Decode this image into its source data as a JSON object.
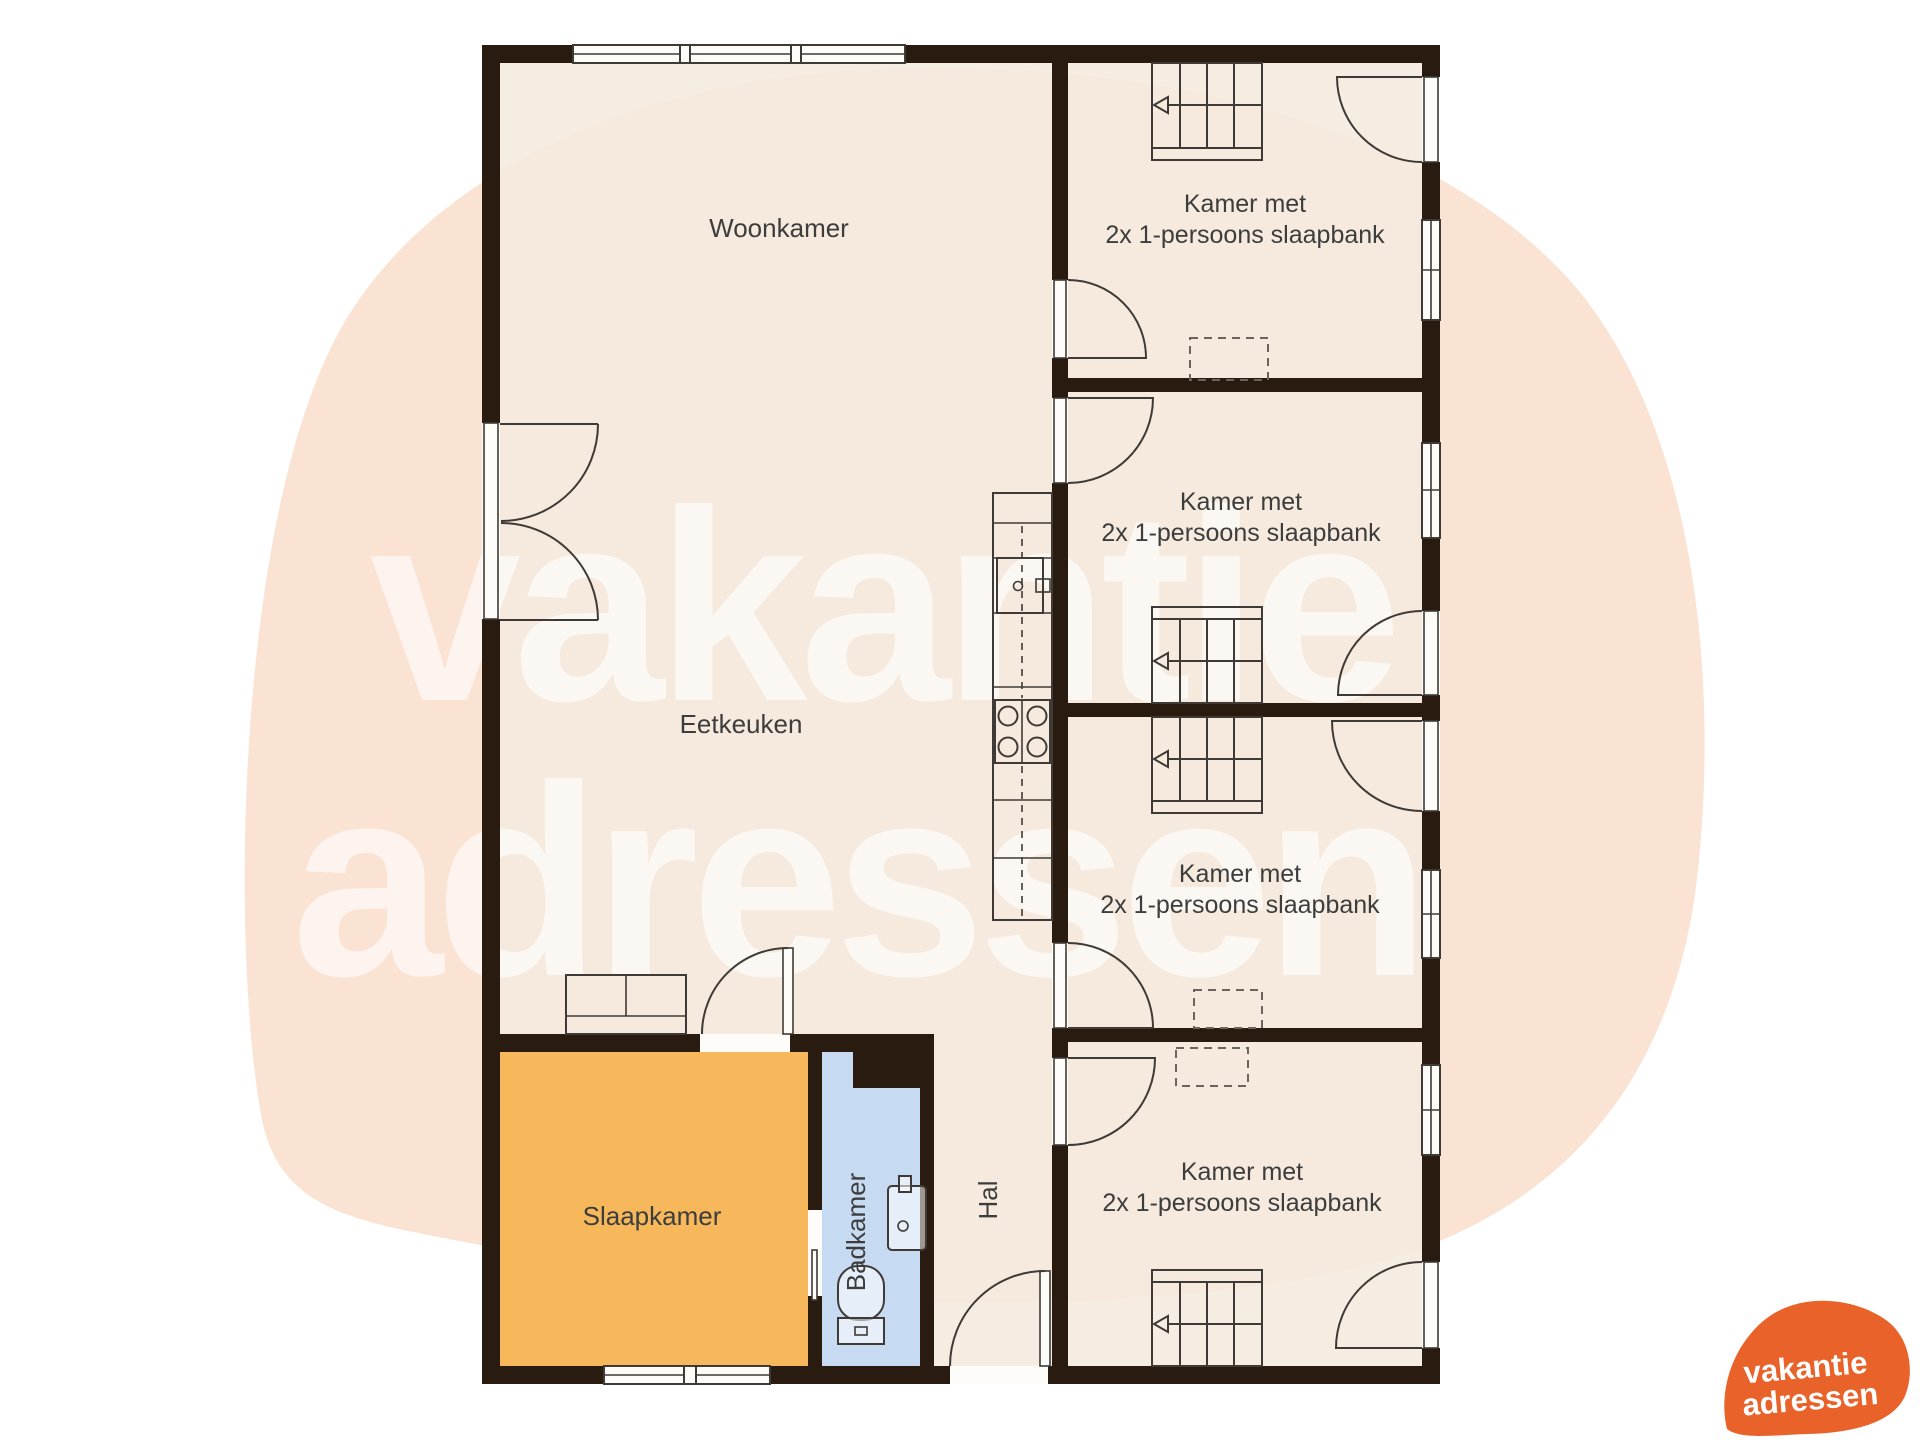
{
  "watermark": {
    "line1": "vakantie",
    "line2": "adressen"
  },
  "logo": {
    "line1": "vakantie",
    "line2": "adressen",
    "color": "#e8622a"
  },
  "rooms": {
    "woonkamer": {
      "label": "Woonkamer"
    },
    "eetkeuken": {
      "label": "Eetkeuken"
    },
    "slaapkamer": {
      "label": "Slaapkamer",
      "color": "#f7b85c"
    },
    "badkamer": {
      "label": "Badkamer",
      "color": "#c6daf2"
    },
    "hal": {
      "label": "Hal"
    },
    "kamer1": {
      "line1": "Kamer met",
      "line2": "2x 1-persoons slaapbank"
    },
    "kamer2": {
      "line1": "Kamer met",
      "line2": "2x 1-persoons slaapbank"
    },
    "kamer3": {
      "line1": "Kamer met",
      "line2": "2x 1-persoons slaapbank"
    },
    "kamer4": {
      "line1": "Kamer met",
      "line2": "2x 1-persoons slaapbank"
    }
  },
  "colors": {
    "wall": "#2a1b11",
    "floor": "#f4eade",
    "blob": "#fbe3d4",
    "line": "#3f3a35",
    "label": "#3d3d3d"
  }
}
